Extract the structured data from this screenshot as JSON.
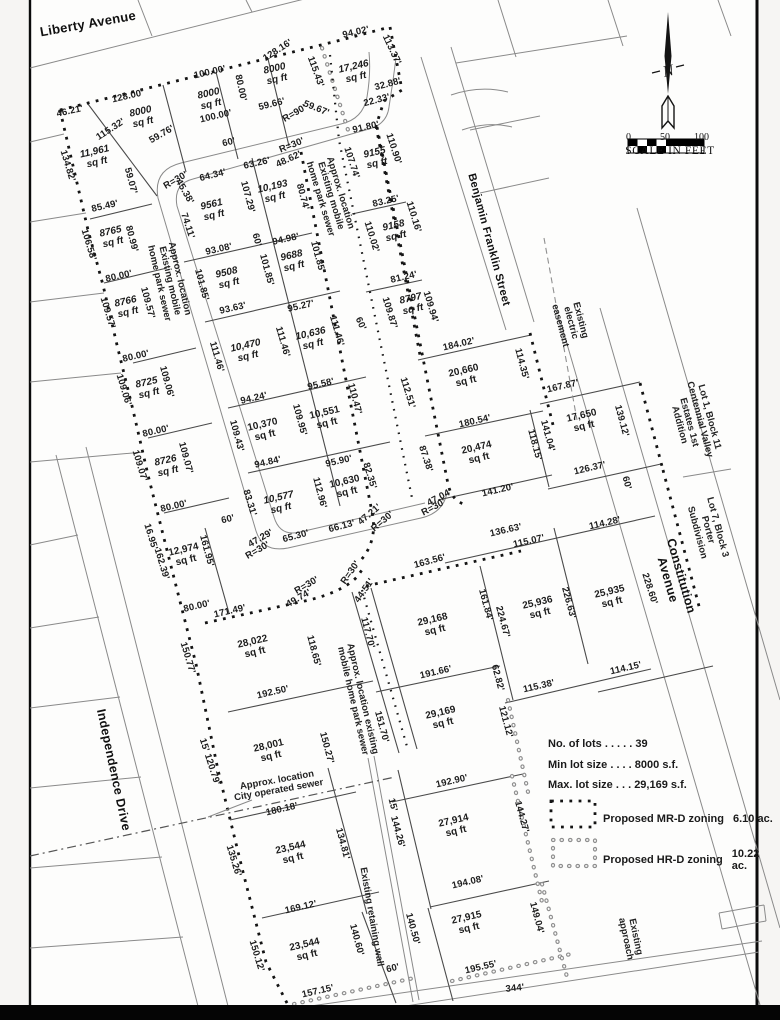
{
  "north": {
    "label": "N"
  },
  "scale": {
    "ticks": [
      "0",
      "50",
      "100"
    ],
    "caption": "SCALE IN FEET"
  },
  "legend": {
    "stats": [
      "No. of lots . . . . . 39",
      "Min lot size . . . . 8000 s.f.",
      "Max. lot size . . . 29,169 s.f."
    ],
    "zones": [
      {
        "label": "Proposed MR-D zoning",
        "value": "6.10 ac.",
        "swatch": "black-dotted-square"
      },
      {
        "label": "Proposed HR-D zoning",
        "value": "10.22 ac.",
        "swatch": "open-dotted-square"
      }
    ]
  },
  "streets": [
    {
      "t": "Liberty Avenue",
      "x": 88,
      "y": 24,
      "r": -10,
      "fs": 13,
      "nm": "street-label-liberty-avenue"
    },
    {
      "t": "Benjamin Franklin Street",
      "x": 488,
      "y": 240,
      "r": 75,
      "fs": 11,
      "nm": "street-label-benjamin-franklin-street"
    },
    {
      "t": "Independence Drive",
      "x": 113,
      "y": 770,
      "r": 78,
      "fs": 12.5,
      "nm": "street-label-independence-drive"
    },
    {
      "t": "Constitution Avenue",
      "x": 674,
      "y": 578,
      "r": 74,
      "fs": 12.5,
      "nm": "street-label-constitution-avenue"
    }
  ],
  "notes": [
    {
      "t": "Approx. location\nExisting mobile\nhome park sewer",
      "x": 169,
      "y": 281,
      "r": 77
    },
    {
      "t": "Approx. location\nExisting mobile\nhome park sewer",
      "x": 330,
      "y": 196,
      "r": 73
    },
    {
      "t": "Existing\nelectric\neasement",
      "x": 570,
      "y": 323,
      "r": 75
    },
    {
      "t": "Lot 1, Block 11\nCentennial Valley\nEstates 1st Addition",
      "x": 694,
      "y": 421,
      "r": 75
    },
    {
      "t": "Lot 7, Block 3\nPorter Subdivision",
      "x": 707,
      "y": 530,
      "r": 75
    },
    {
      "t": "Approx. location existing\nmobile home park sewer",
      "x": 357,
      "y": 700,
      "r": 77
    },
    {
      "t": "Approx. location\nCity operated sewer",
      "x": 278,
      "y": 786,
      "r": -10
    },
    {
      "t": "Existing retaining wall",
      "x": 371,
      "y": 917,
      "r": 80
    },
    {
      "t": "Existing\napproach",
      "x": 630,
      "y": 938,
      "r": 78
    }
  ],
  "labels": [
    {
      "t": "46.21'",
      "x": 70,
      "y": 112,
      "r": -13
    },
    {
      "t": "128.00'",
      "x": 128,
      "y": 97,
      "r": -13
    },
    {
      "t": "115.32'",
      "x": 111,
      "y": 130,
      "r": -33
    },
    {
      "t": "134.82'",
      "x": 67,
      "y": 166,
      "r": 73
    },
    {
      "t": "100.00'",
      "x": 210,
      "y": 73,
      "r": -13
    },
    {
      "t": "80.00'",
      "x": 240,
      "y": 88,
      "r": 78
    },
    {
      "t": "128.16'",
      "x": 278,
      "y": 51,
      "r": -33
    },
    {
      "t": "100.00'",
      "x": 216,
      "y": 117,
      "r": -13
    },
    {
      "t": "60'",
      "x": 229,
      "y": 143,
      "r": -13
    },
    {
      "t": "59.76'",
      "x": 162,
      "y": 135,
      "r": -30
    },
    {
      "t": "59.66'",
      "x": 272,
      "y": 105,
      "r": -14
    },
    {
      "t": "59.67'",
      "x": 316,
      "y": 109,
      "r": 22
    },
    {
      "t": "R=90'",
      "x": 295,
      "y": 114,
      "r": -30
    },
    {
      "t": "R=30'",
      "x": 292,
      "y": 146,
      "r": -22
    },
    {
      "t": "94.02'",
      "x": 356,
      "y": 33,
      "r": -13
    },
    {
      "t": "113.37'",
      "x": 391,
      "y": 50,
      "r": 65
    },
    {
      "t": "32.88'",
      "x": 388,
      "y": 85,
      "r": -15
    },
    {
      "t": "22.33'",
      "x": 377,
      "y": 101,
      "r": -15
    },
    {
      "t": "91.80'",
      "x": 366,
      "y": 128,
      "r": -13
    },
    {
      "t": "110.90'",
      "x": 393,
      "y": 149,
      "r": 72
    },
    {
      "t": "107.74'",
      "x": 351,
      "y": 163,
      "r": 72
    },
    {
      "t": "115.43'",
      "x": 315,
      "y": 72,
      "r": 70
    },
    {
      "t": "59.07'",
      "x": 130,
      "y": 181,
      "r": 75
    },
    {
      "t": "85.49'",
      "x": 105,
      "y": 207,
      "r": -13
    },
    {
      "t": "64.34'",
      "x": 213,
      "y": 176,
      "r": -14
    },
    {
      "t": "45.38'",
      "x": 184,
      "y": 192,
      "r": 60
    },
    {
      "t": "R=30'",
      "x": 176,
      "y": 181,
      "r": -30
    },
    {
      "t": "63.26'",
      "x": 257,
      "y": 164,
      "r": -13
    },
    {
      "t": "48.62'",
      "x": 289,
      "y": 160,
      "r": -25
    },
    {
      "t": "74.11'",
      "x": 187,
      "y": 226,
      "r": 72
    },
    {
      "t": "107.29'",
      "x": 247,
      "y": 197,
      "r": 75
    },
    {
      "t": "80.74'",
      "x": 302,
      "y": 197,
      "r": 75
    },
    {
      "t": "106.58'",
      "x": 88,
      "y": 245,
      "r": 73
    },
    {
      "t": "80.99'",
      "x": 131,
      "y": 239,
      "r": 75
    },
    {
      "t": "93.08'",
      "x": 219,
      "y": 250,
      "r": -13
    },
    {
      "t": "94.98'",
      "x": 286,
      "y": 240,
      "r": -13
    },
    {
      "t": "60'",
      "x": 256,
      "y": 240,
      "r": 75
    },
    {
      "t": "101.85'",
      "x": 266,
      "y": 270,
      "r": 75
    },
    {
      "t": "101.85'",
      "x": 317,
      "y": 257,
      "r": 75
    },
    {
      "t": "101.85'",
      "x": 201,
      "y": 285,
      "r": 75
    },
    {
      "t": "80.00'",
      "x": 119,
      "y": 277,
      "r": -13
    },
    {
      "t": "109.57'",
      "x": 107,
      "y": 313,
      "r": 73
    },
    {
      "t": "109.57'",
      "x": 147,
      "y": 303,
      "r": 75
    },
    {
      "t": "93.63'",
      "x": 233,
      "y": 309,
      "r": -13
    },
    {
      "t": "95.27'",
      "x": 301,
      "y": 307,
      "r": -13
    },
    {
      "t": "111.46'",
      "x": 216,
      "y": 357,
      "r": 74
    },
    {
      "t": "111.46'",
      "x": 282,
      "y": 342,
      "r": 74
    },
    {
      "t": "111.46'",
      "x": 336,
      "y": 331,
      "r": 74
    },
    {
      "t": "60'",
      "x": 360,
      "y": 324,
      "r": 65
    },
    {
      "t": "109.87'",
      "x": 389,
      "y": 313,
      "r": 73
    },
    {
      "t": "109.94'",
      "x": 430,
      "y": 307,
      "r": 73
    },
    {
      "t": "83.25'",
      "x": 386,
      "y": 202,
      "r": -13
    },
    {
      "t": "110.16'",
      "x": 413,
      "y": 217,
      "r": 73
    },
    {
      "t": "110.02'",
      "x": 371,
      "y": 237,
      "r": 73
    },
    {
      "t": "81.24'",
      "x": 404,
      "y": 278,
      "r": -13
    },
    {
      "t": "80.00'",
      "x": 136,
      "y": 357,
      "r": -13
    },
    {
      "t": "109.06'",
      "x": 123,
      "y": 390,
      "r": 73
    },
    {
      "t": "109.06'",
      "x": 166,
      "y": 382,
      "r": 75
    },
    {
      "t": "94.24'",
      "x": 254,
      "y": 399,
      "r": -13
    },
    {
      "t": "109.43'",
      "x": 236,
      "y": 436,
      "r": 75
    },
    {
      "t": "109.95'",
      "x": 299,
      "y": 420,
      "r": 75
    },
    {
      "t": "110.47'",
      "x": 354,
      "y": 399,
      "r": 75
    },
    {
      "t": "95.58'",
      "x": 321,
      "y": 385,
      "r": -13
    },
    {
      "t": "80.00'",
      "x": 156,
      "y": 432,
      "r": -13
    },
    {
      "t": "109.07'",
      "x": 139,
      "y": 466,
      "r": 73
    },
    {
      "t": "109.07'",
      "x": 185,
      "y": 458,
      "r": 75
    },
    {
      "t": "94.84'",
      "x": 268,
      "y": 463,
      "r": -13
    },
    {
      "t": "95.90'",
      "x": 339,
      "y": 462,
      "r": -13
    },
    {
      "t": "82.35'",
      "x": 369,
      "y": 476,
      "r": 73
    },
    {
      "t": "112.96'",
      "x": 319,
      "y": 493,
      "r": 75
    },
    {
      "t": "83.31'",
      "x": 249,
      "y": 503,
      "r": 73
    },
    {
      "t": "80.00'",
      "x": 174,
      "y": 507,
      "r": -13
    },
    {
      "t": "60'",
      "x": 228,
      "y": 520,
      "r": -13
    },
    {
      "t": "47.29'",
      "x": 261,
      "y": 539,
      "r": -30
    },
    {
      "t": "R=30'",
      "x": 258,
      "y": 551,
      "r": -30
    },
    {
      "t": "65.30'",
      "x": 296,
      "y": 537,
      "r": -15
    },
    {
      "t": "66.13'",
      "x": 342,
      "y": 527,
      "r": -15
    },
    {
      "t": "47.21'",
      "x": 370,
      "y": 515,
      "r": -40
    },
    {
      "t": "R=30'",
      "x": 383,
      "y": 522,
      "r": -40
    },
    {
      "t": "47.04'",
      "x": 440,
      "y": 498,
      "r": -28
    },
    {
      "t": "R=30'",
      "x": 434,
      "y": 508,
      "r": -28
    },
    {
      "t": "87.38'",
      "x": 425,
      "y": 459,
      "r": 72
    },
    {
      "t": "112.51'",
      "x": 407,
      "y": 393,
      "r": 73
    },
    {
      "t": "184.02'",
      "x": 459,
      "y": 345,
      "r": -13
    },
    {
      "t": "114.35'",
      "x": 521,
      "y": 364,
      "r": 75
    },
    {
      "t": "167.87'",
      "x": 563,
      "y": 387,
      "r": -13
    },
    {
      "t": "180.54'",
      "x": 475,
      "y": 422,
      "r": -13
    },
    {
      "t": "118.15'",
      "x": 534,
      "y": 445,
      "r": 75
    },
    {
      "t": "141.04'",
      "x": 547,
      "y": 436,
      "r": 75
    },
    {
      "t": "139.12'",
      "x": 621,
      "y": 421,
      "r": 75
    },
    {
      "t": "126.37'",
      "x": 590,
      "y": 469,
      "r": -13
    },
    {
      "t": "141.20'",
      "x": 498,
      "y": 491,
      "r": -13
    },
    {
      "t": "60'",
      "x": 626,
      "y": 483,
      "r": 75
    },
    {
      "t": "114.28'",
      "x": 605,
      "y": 524,
      "r": -13
    },
    {
      "t": "136.63'",
      "x": 506,
      "y": 531,
      "r": -13
    },
    {
      "t": "115.07'",
      "x": 529,
      "y": 542,
      "r": -13
    },
    {
      "t": "163.56'",
      "x": 430,
      "y": 562,
      "r": -15
    },
    {
      "t": "161.95'",
      "x": 206,
      "y": 551,
      "r": 75
    },
    {
      "t": "162.39'",
      "x": 161,
      "y": 564,
      "r": 73
    },
    {
      "t": "16.95'",
      "x": 150,
      "y": 537,
      "r": 73
    },
    {
      "t": "80.00'",
      "x": 197,
      "y": 607,
      "r": -13
    },
    {
      "t": "171.49'",
      "x": 230,
      "y": 612,
      "r": -13
    },
    {
      "t": "49.74'",
      "x": 299,
      "y": 599,
      "r": -30
    },
    {
      "t": "R=30'",
      "x": 307,
      "y": 586,
      "r": -30
    },
    {
      "t": "R=30'",
      "x": 351,
      "y": 573,
      "r": -55
    },
    {
      "t": "44.51'",
      "x": 365,
      "y": 591,
      "r": -55
    },
    {
      "t": "117.70'",
      "x": 367,
      "y": 633,
      "r": 75
    },
    {
      "t": "118.65'",
      "x": 313,
      "y": 651,
      "r": 75
    },
    {
      "t": "150.77'",
      "x": 187,
      "y": 658,
      "r": 73
    },
    {
      "t": "192.50'",
      "x": 273,
      "y": 693,
      "r": -13
    },
    {
      "t": "161.84'",
      "x": 485,
      "y": 605,
      "r": 75
    },
    {
      "t": "224.67'",
      "x": 502,
      "y": 622,
      "r": 75
    },
    {
      "t": "226.63'",
      "x": 568,
      "y": 603,
      "r": 75
    },
    {
      "t": "228.60'",
      "x": 649,
      "y": 589,
      "r": 72
    },
    {
      "t": "114.15'",
      "x": 626,
      "y": 669,
      "r": -13
    },
    {
      "t": "115.38'",
      "x": 539,
      "y": 687,
      "r": -13
    },
    {
      "t": "191.66'",
      "x": 436,
      "y": 673,
      "r": -13
    },
    {
      "t": "62.82'",
      "x": 497,
      "y": 678,
      "r": 75
    },
    {
      "t": "121.12'",
      "x": 505,
      "y": 722,
      "r": 75
    },
    {
      "t": "151.70'",
      "x": 381,
      "y": 727,
      "r": 75
    },
    {
      "t": "150.27'",
      "x": 326,
      "y": 748,
      "r": 75
    },
    {
      "t": "15' 120.79'",
      "x": 209,
      "y": 762,
      "r": 72
    },
    {
      "t": "192.90'",
      "x": 452,
      "y": 782,
      "r": -13
    },
    {
      "t": "180.18'",
      "x": 282,
      "y": 810,
      "r": -13
    },
    {
      "t": "135.26'",
      "x": 233,
      "y": 861,
      "r": 73
    },
    {
      "t": "134.81'",
      "x": 342,
      "y": 844,
      "r": 75
    },
    {
      "t": "15'",
      "x": 392,
      "y": 805,
      "r": 75
    },
    {
      "t": "144.26'",
      "x": 397,
      "y": 832,
      "r": 75
    },
    {
      "t": "144.27'",
      "x": 521,
      "y": 817,
      "r": 75
    },
    {
      "t": "169.12'",
      "x": 301,
      "y": 908,
      "r": -13
    },
    {
      "t": "150.12'",
      "x": 256,
      "y": 956,
      "r": 73
    },
    {
      "t": "157.15'",
      "x": 318,
      "y": 992,
      "r": -13
    },
    {
      "t": "140.60'",
      "x": 356,
      "y": 940,
      "r": 75
    },
    {
      "t": "60'",
      "x": 393,
      "y": 969,
      "r": -13
    },
    {
      "t": "140.50'",
      "x": 412,
      "y": 929,
      "r": 75
    },
    {
      "t": "194.08'",
      "x": 468,
      "y": 883,
      "r": -13
    },
    {
      "t": "149.04'",
      "x": 536,
      "y": 918,
      "r": 75
    },
    {
      "t": "195.55'",
      "x": 481,
      "y": 968,
      "r": -13
    },
    {
      "t": "344'",
      "x": 515,
      "y": 989,
      "r": -6
    },
    {
      "t": "11,961\nsq ft",
      "x": 96,
      "y": 158,
      "r": -13,
      "c": "a",
      "i": 1
    },
    {
      "t": "8000\nsq ft",
      "x": 142,
      "y": 118,
      "r": -13,
      "c": "a",
      "i": 1
    },
    {
      "t": "8000\nsq ft",
      "x": 210,
      "y": 100,
      "r": -13,
      "c": "a",
      "i": 1
    },
    {
      "t": "8000\nsq ft",
      "x": 276,
      "y": 75,
      "r": -13,
      "c": "a",
      "i": 1
    },
    {
      "t": "17,246\nsq ft",
      "x": 355,
      "y": 73,
      "r": -13,
      "c": "a",
      "i": 1
    },
    {
      "t": "9155\nsq ft",
      "x": 376,
      "y": 159,
      "r": -13,
      "c": "a",
      "i": 1
    },
    {
      "t": "9158\nsq ft",
      "x": 395,
      "y": 232,
      "r": -13,
      "c": "a",
      "i": 1
    },
    {
      "t": "8797\nsq ft",
      "x": 412,
      "y": 305,
      "r": -13,
      "c": "a",
      "i": 1
    },
    {
      "t": "9561\nsq ft",
      "x": 213,
      "y": 211,
      "r": -13,
      "c": "a",
      "i": 1
    },
    {
      "t": "10,193\nsq ft",
      "x": 274,
      "y": 193,
      "r": -13,
      "c": "a",
      "i": 1
    },
    {
      "t": "9508\nsq ft",
      "x": 228,
      "y": 279,
      "r": -13,
      "c": "a",
      "i": 1
    },
    {
      "t": "9688\nsq ft",
      "x": 293,
      "y": 262,
      "r": -13,
      "c": "a",
      "i": 1
    },
    {
      "t": "8765\nsq ft",
      "x": 112,
      "y": 238,
      "r": -13,
      "c": "a",
      "i": 1
    },
    {
      "t": "8766\nsq ft",
      "x": 127,
      "y": 308,
      "r": -13,
      "c": "a",
      "i": 1
    },
    {
      "t": "8725\nsq ft",
      "x": 148,
      "y": 389,
      "r": -13,
      "c": "a",
      "i": 1
    },
    {
      "t": "8726\nsq ft",
      "x": 167,
      "y": 467,
      "r": -13,
      "c": "a",
      "i": 1
    },
    {
      "t": "10,470\nsq ft",
      "x": 247,
      "y": 352,
      "r": -13,
      "c": "a",
      "i": 1
    },
    {
      "t": "10,636\nsq ft",
      "x": 312,
      "y": 340,
      "r": -13,
      "c": "a",
      "i": 1
    },
    {
      "t": "10,370\nsq ft",
      "x": 264,
      "y": 431,
      "r": -13,
      "c": "a"
    },
    {
      "t": "10,551\nsq ft",
      "x": 326,
      "y": 419,
      "r": -13,
      "c": "a"
    },
    {
      "t": "10,577\nsq ft",
      "x": 280,
      "y": 504,
      "r": -13,
      "c": "a",
      "i": 1
    },
    {
      "t": "10,630\nsq ft",
      "x": 346,
      "y": 488,
      "r": -13,
      "c": "a"
    },
    {
      "t": "12,974\nsq ft",
      "x": 185,
      "y": 556,
      "r": -13,
      "c": "a"
    },
    {
      "t": "20,660\nsq ft",
      "x": 465,
      "y": 377,
      "r": -13,
      "c": "a"
    },
    {
      "t": "20,474\nsq ft",
      "x": 478,
      "y": 454,
      "r": -13,
      "c": "a"
    },
    {
      "t": "17,650\nsq ft",
      "x": 583,
      "y": 422,
      "r": -13,
      "c": "a"
    },
    {
      "t": "25,936\nsq ft",
      "x": 539,
      "y": 609,
      "r": -13,
      "c": "a"
    },
    {
      "t": "25,935\nsq ft",
      "x": 611,
      "y": 598,
      "r": -13,
      "c": "a"
    },
    {
      "t": "29,168\nsq ft",
      "x": 434,
      "y": 626,
      "r": -13,
      "c": "a"
    },
    {
      "t": "28,022\nsq ft",
      "x": 254,
      "y": 648,
      "r": -13,
      "c": "a"
    },
    {
      "t": "29,169\nsq ft",
      "x": 442,
      "y": 719,
      "r": -13,
      "c": "a"
    },
    {
      "t": "28,001\nsq ft",
      "x": 270,
      "y": 752,
      "r": -13,
      "c": "a"
    },
    {
      "t": "27,914\nsq ft",
      "x": 455,
      "y": 827,
      "r": -13,
      "c": "a"
    },
    {
      "t": "23,544\nsq ft",
      "x": 292,
      "y": 854,
      "r": -13,
      "c": "a"
    },
    {
      "t": "27,915\nsq ft",
      "x": 468,
      "y": 924,
      "r": -13,
      "c": "a"
    },
    {
      "t": "23,544\nsq ft",
      "x": 306,
      "y": 951,
      "r": -13,
      "c": "a"
    }
  ]
}
